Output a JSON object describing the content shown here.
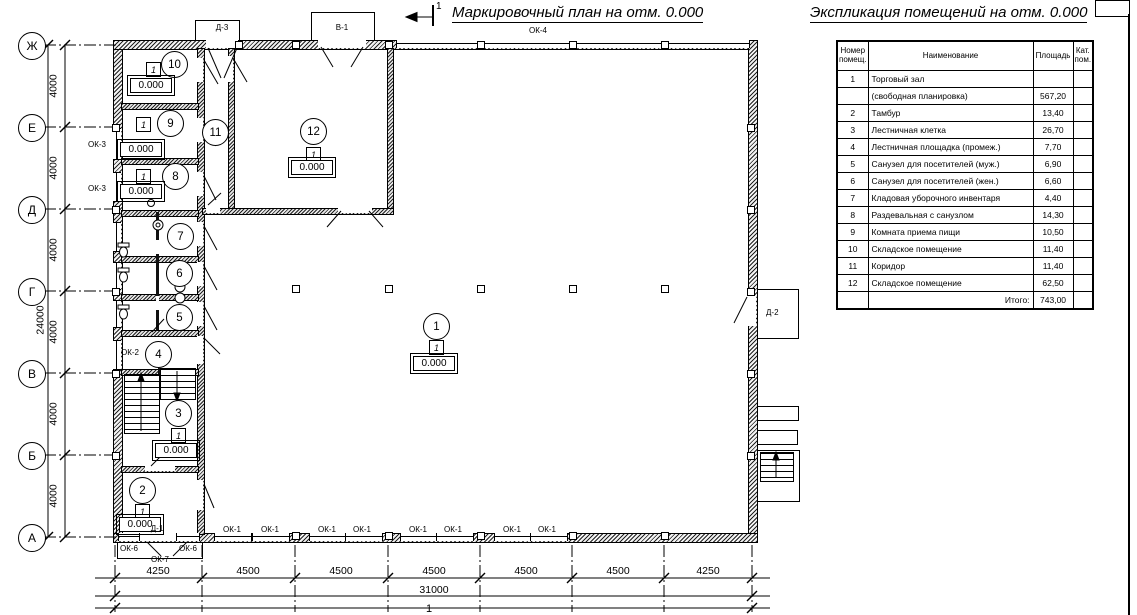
{
  "titles": {
    "plan": "Маркировочный план на отм. 0.000",
    "explication": "Экспликация помещений на отм. 0.000",
    "section": "1"
  },
  "table": {
    "header": {
      "num": "Номер помещ.",
      "name": "Наименование",
      "area": "Площадь",
      "cat": "Кат. пом."
    },
    "rows": [
      {
        "num": "1",
        "name": "Торговый зал",
        "area": "",
        "cat": ""
      },
      {
        "num": "",
        "name": "(свободная планировка)",
        "area": "567,20",
        "cat": ""
      },
      {
        "num": "2",
        "name": "Тамбур",
        "area": "13,40",
        "cat": ""
      },
      {
        "num": "3",
        "name": "Лестничная клетка",
        "area": "26,70",
        "cat": ""
      },
      {
        "num": "4",
        "name": "Лестничная площадка (промеж.)",
        "area": "7,70",
        "cat": ""
      },
      {
        "num": "5",
        "name": "Санузел для посетителей (муж.)",
        "area": "6,90",
        "cat": ""
      },
      {
        "num": "6",
        "name": "Санузел для посетителей (жен.)",
        "area": "6,60",
        "cat": ""
      },
      {
        "num": "7",
        "name": "Кладовая уборочного инвентаря",
        "area": "4,40",
        "cat": ""
      },
      {
        "num": "8",
        "name": "Раздевальная с санузлом",
        "area": "14,30",
        "cat": ""
      },
      {
        "num": "9",
        "name": "Комната приема пищи",
        "area": "10,50",
        "cat": ""
      },
      {
        "num": "10",
        "name": "Складское помещение",
        "area": "11,40",
        "cat": ""
      },
      {
        "num": "11",
        "name": "Коридор",
        "area": "11,40",
        "cat": ""
      },
      {
        "num": "12",
        "name": "Складское помещение",
        "area": "62,50",
        "cat": ""
      },
      {
        "num": "",
        "name": "Итого:",
        "area": "743,00",
        "cat": ""
      }
    ]
  },
  "axes": [
    "Ж",
    "Е",
    "Д",
    "Г",
    "В",
    "Б",
    "А"
  ],
  "dims": {
    "d4000": "4000",
    "d24000": "24000",
    "d4250": "4250",
    "d4500": "4500",
    "d31000": "31000"
  },
  "tags": {
    "ok1": "ОК-1",
    "ok2": "ОК-2",
    "ok3": "ОК-3",
    "ok4": "ОК-4",
    "ok6": "ОК-6",
    "ok7": "ОК-7",
    "d1": "Д-1",
    "d2": "Д-2",
    "d3": "Д-3",
    "v1": "В-1"
  },
  "rooms": [
    "1",
    "2",
    "3",
    "4",
    "5",
    "6",
    "7",
    "8",
    "9",
    "10",
    "11",
    "12"
  ],
  "marks": {
    "type": "1",
    "elev": "0.000"
  }
}
